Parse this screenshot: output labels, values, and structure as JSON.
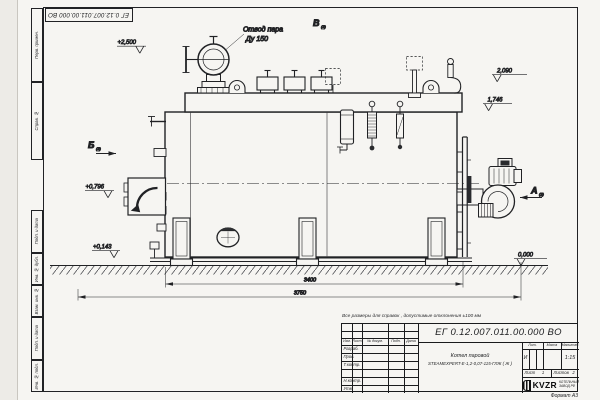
{
  "sheet": {
    "stamp_rotated": "ЕГ 0.12.007.011.00.000  ВО",
    "note": "Все размеры для справок , допустимые отклонения  ±100 мм",
    "format_label": "Формат А3",
    "margin_labels": [
      "Перв. примен.",
      "Справ. №",
      "Подп. и дата",
      "Инв. № дубл.",
      "Взам. инв. №",
      "Подп. и дата",
      "Инв. № подл."
    ]
  },
  "drawing": {
    "callout": {
      "line1": "Отвод пара",
      "line2": "Ду 150"
    },
    "views": {
      "top": {
        "letter": "В",
        "sub": "(2)"
      },
      "front_left": {
        "letter": "Б",
        "sub": "(2)"
      },
      "right": {
        "letter": "А",
        "sub": "(2)"
      }
    },
    "elevations": {
      "e2500": "+2,500",
      "e2090": "2,090",
      "e1746": "1,746",
      "e0796": "+0,796",
      "e0143": "+0,143",
      "e0000": "0,000"
    },
    "dimensions": {
      "body_length": "3400",
      "overall_length": "3750"
    }
  },
  "title_block": {
    "designation": "ЕГ 0.12.007.011.00.000  ВО",
    "product_line1": "Котел паровой",
    "product_line2": "STEAMEXPERT-Е-1,2-0,07-115-ГЛЖ ( Ж )",
    "header_cols": [
      "Изм.",
      "Лист",
      "№ докум.",
      "Подп.",
      "Дата"
    ],
    "row_labels": [
      "Разраб.",
      "Пров.",
      "Т.контр.",
      "",
      "Н.контр.",
      "Утв."
    ],
    "lit_label": "Лит.",
    "lit_value": "И",
    "mass_label": "Масса",
    "scale_label": "Масштаб",
    "scale_value": "1:15",
    "sheet_label": "Лист",
    "sheet_value": "1",
    "sheets_label": "Листов",
    "sheets_value": "2",
    "logo_text": "KVZR",
    "org_line1": "КОТЕЛЬНЫЙ",
    "org_line2": "ЗАВОД РФ"
  }
}
